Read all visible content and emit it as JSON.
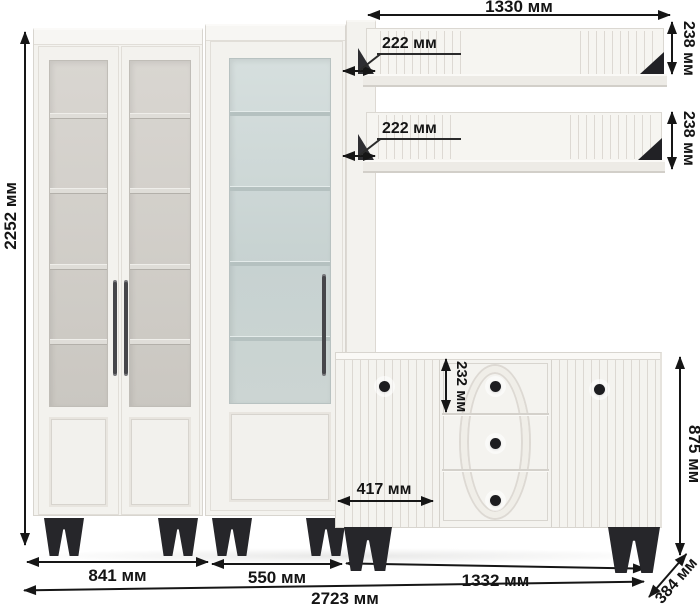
{
  "dims": {
    "total_height": "2252 мм",
    "shelf_width": "1330 мм",
    "shelf1_depth": "222 мм",
    "shelf2_depth": "222 мм",
    "shelf1_height": "238 мм",
    "shelf2_height": "238 мм",
    "drawer_height": "232 мм",
    "door_width": "417 мм",
    "sideboard_height": "875 мм",
    "bookcase_width": "841 мм",
    "display_cabinet_width": "550 мм",
    "sideboard_width": "1332 мм",
    "total_width": "2723 мм",
    "sideboard_depth": "384 мм"
  },
  "colors": {
    "furniture_body": "#f4f3ef",
    "furniture_edge": "#d8d5cf",
    "cabinet_interior": "#d2cfc9",
    "display_glass": "#ccd6d5",
    "accent_black": "#232327",
    "dimension_ink": "#161616",
    "background": "#ffffff"
  }
}
